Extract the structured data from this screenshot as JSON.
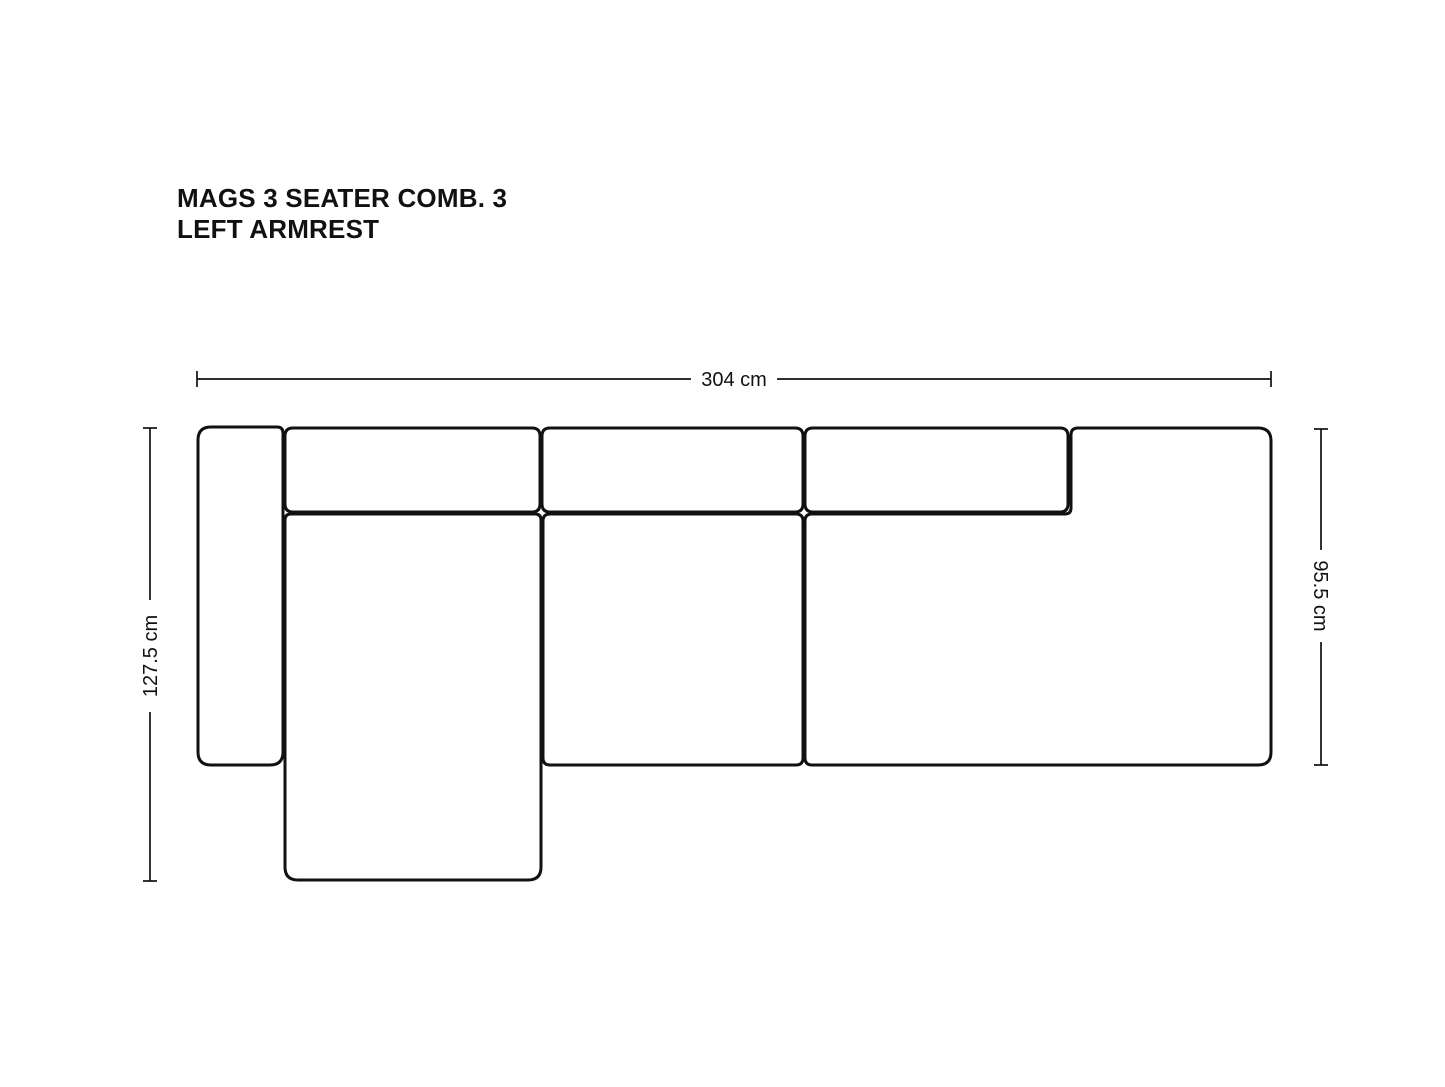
{
  "page": {
    "background_color": "#ffffff"
  },
  "title": {
    "line1": "MAGS 3 SEATER COMB. 3",
    "line2": "LEFT ARMREST"
  },
  "diagram": {
    "kind": "sofa-top-view-dimension-drawing",
    "line_color": "#111111",
    "dimension_labels": {
      "overall_width": "304 cm",
      "total_depth_with_chaise": "127.5 cm",
      "seat_section_depth": "95.5 cm"
    },
    "pieces": [
      "left-armrest",
      "backrest-left",
      "backrest-middle",
      "backrest-right",
      "chaise-longue-seat",
      "middle-seat",
      "right-lounge-section"
    ]
  }
}
